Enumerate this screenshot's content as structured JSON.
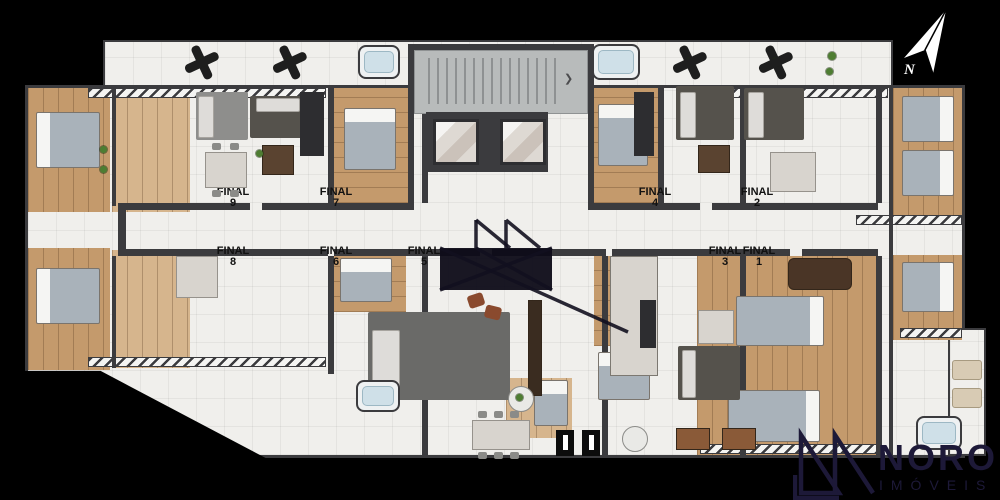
{
  "title": "apartment-floor-plan",
  "units": [
    {
      "word": "FINAL",
      "number": "9"
    },
    {
      "word": "FINAL",
      "number": "7"
    },
    {
      "word": "FINAL",
      "number": "4"
    },
    {
      "word": "FINAL",
      "number": "2"
    },
    {
      "word": "FINAL",
      "number": "8"
    },
    {
      "word": "FINAL",
      "number": "6"
    },
    {
      "word": "FINAL",
      "number": "5"
    },
    {
      "word": "FINAL",
      "number": "3"
    },
    {
      "word": "FINAL",
      "number": "1"
    }
  ],
  "compass": {
    "letter": "N"
  },
  "branding": {
    "name": "NORO",
    "subtitle": "IMÓVEIS"
  },
  "palette": {
    "background": "#000000",
    "wall": "#3b3b3e",
    "floor": "#f0efec",
    "wood": "#c49a6c",
    "rug_dark": "#55524c",
    "brand_navy": "#1d1938",
    "stair_core": "#b8bbbb",
    "water": "#cfe0e8"
  }
}
